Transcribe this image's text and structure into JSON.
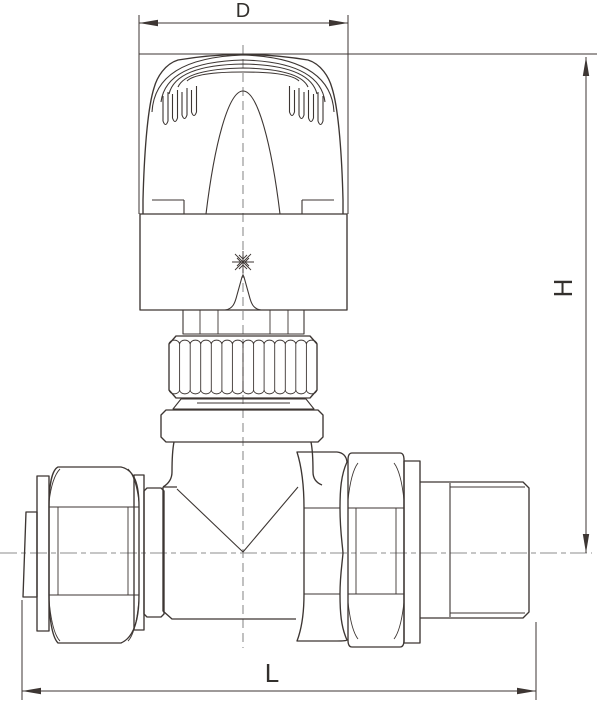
{
  "page": {
    "background": "#ffffff",
    "colors": {
      "line": "#3d3633",
      "centerline": "#8e8e8e",
      "text": "#33302d"
    }
  },
  "drawing": {
    "dimension_labels": {
      "diameter": "D",
      "height": "H",
      "length": "L"
    },
    "symbols": {
      "frost_protection": "snowflake"
    }
  }
}
